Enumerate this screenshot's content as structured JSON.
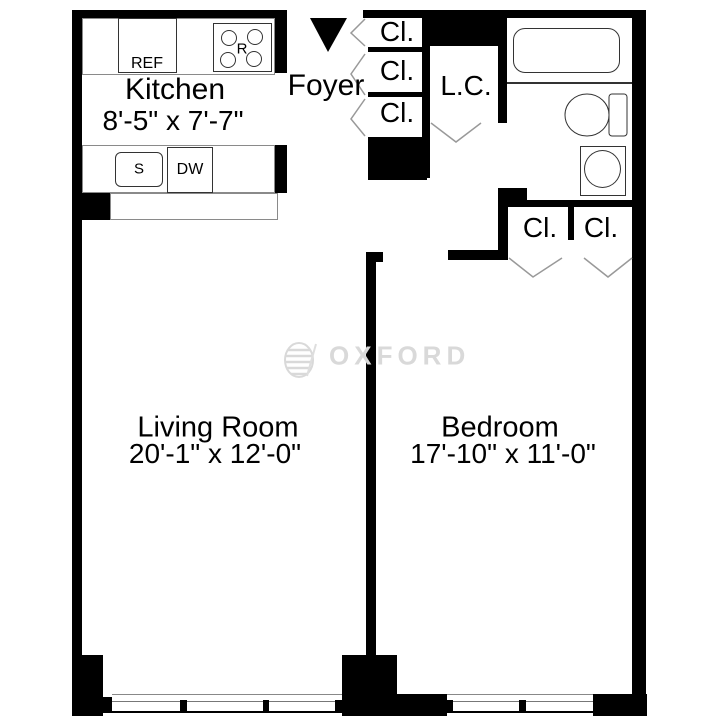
{
  "plan": {
    "rooms": {
      "kitchen": {
        "name": "Kitchen",
        "dims": "8'-5\" x 7'-7\""
      },
      "living_room": {
        "name": "Living Room",
        "dims": "20'-1\" x 12'-0\""
      },
      "bedroom": {
        "name": "Bedroom",
        "dims": "17'-10\" x 11'-0\""
      },
      "foyer": {
        "name": "Foyer"
      },
      "linen_closet": {
        "name": "L.C."
      }
    },
    "closets": {
      "foyer_stack": [
        {
          "label": "Cl."
        },
        {
          "label": "Cl."
        },
        {
          "label": "Cl."
        }
      ],
      "bedroom_pair": [
        {
          "label": "Cl."
        },
        {
          "label": "Cl."
        }
      ]
    },
    "kitchen_fixtures": {
      "refrigerator": "REF",
      "range": "R",
      "sink": "S",
      "dishwasher": "DW"
    }
  },
  "watermark": {
    "text": "OXFORD"
  },
  "colors": {
    "wall": "#000000",
    "background": "#ffffff",
    "fixture_line": "#333333",
    "door_swing": "#999999",
    "watermark": "#d9d9d9"
  }
}
